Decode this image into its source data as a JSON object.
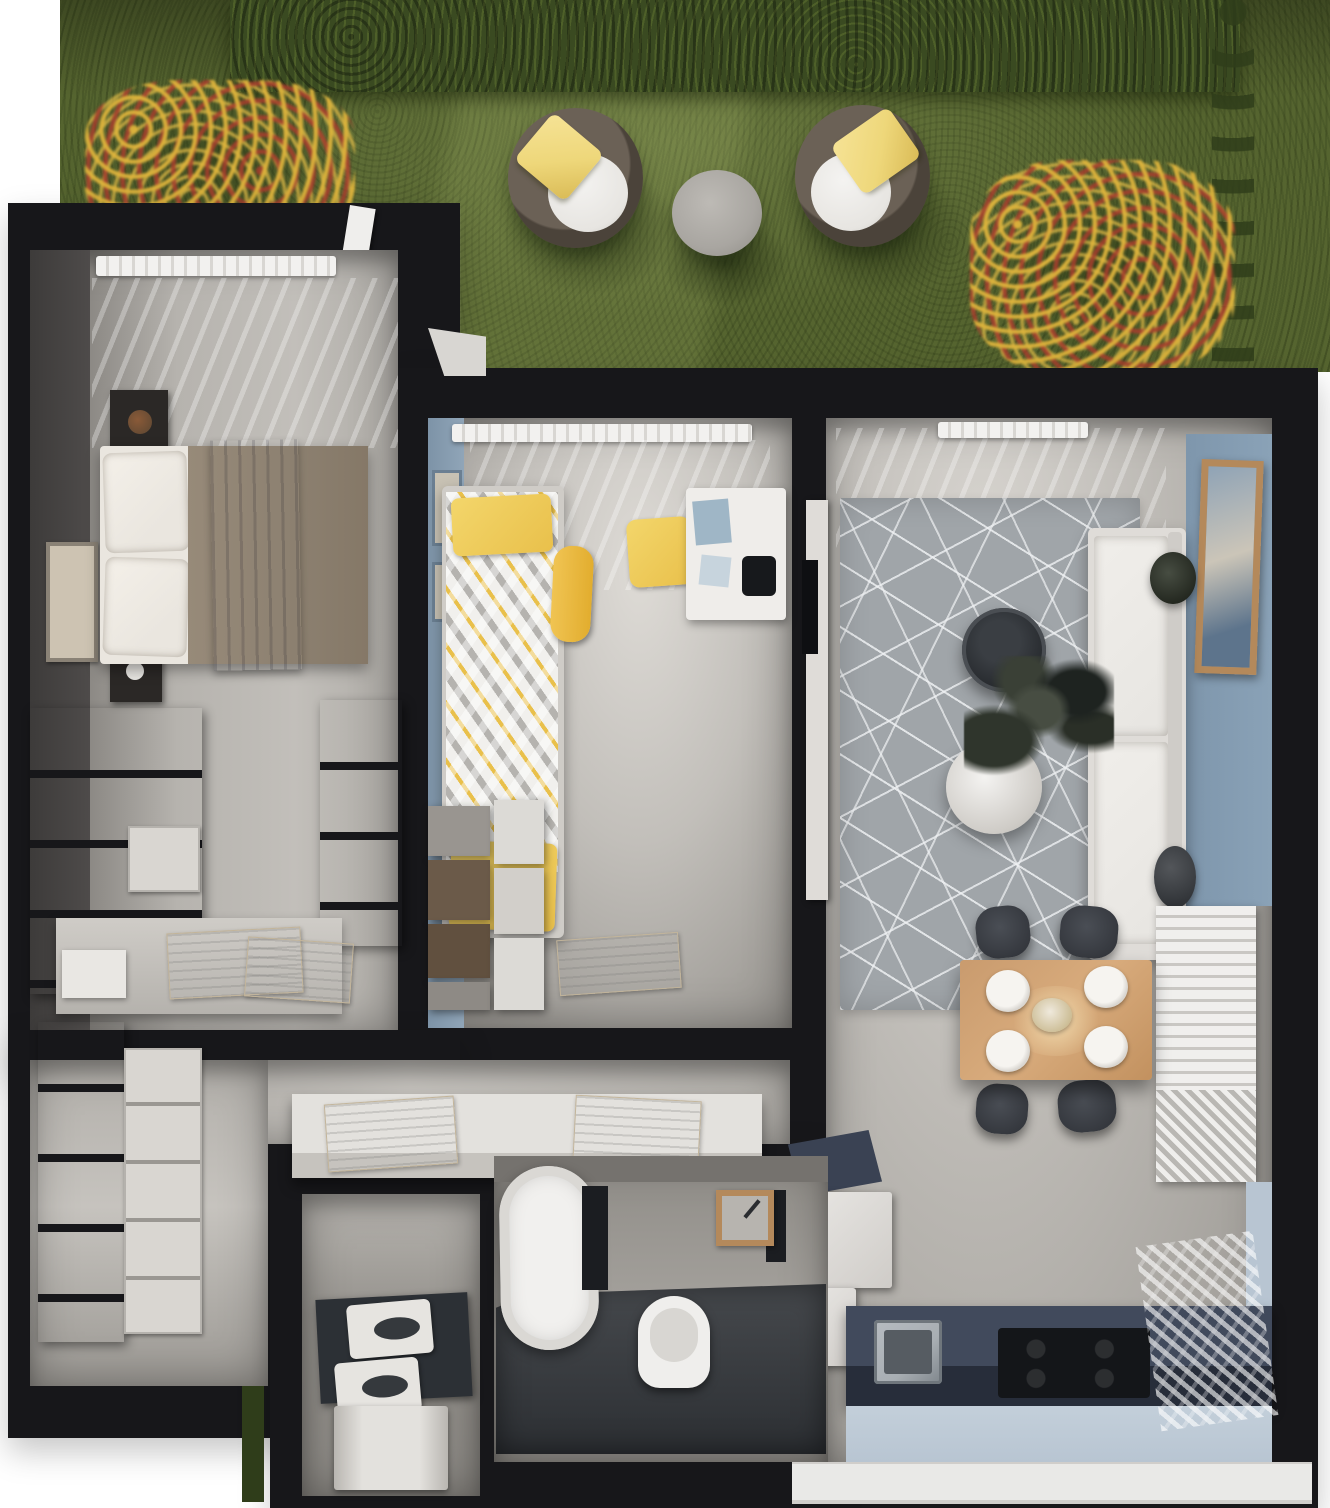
{
  "meta": {
    "title": "apartment-floor-plan-3d-render"
  },
  "palette": {
    "wall": "#17171a",
    "grass": "#55642f",
    "hedge": "#3a4a21",
    "hedgeD": "#2f3d1a",
    "chairFrame": "#4b433a",
    "cushion": "#e7e5e1",
    "pillow": "#eed77a",
    "gtable": "#a9a6a1",
    "bwall": "#4e4b4a",
    "nstand": "#2b2826",
    "linen": "#eae6df",
    "duvet": "#8d8171",
    "throw": "#5b7492",
    "wood": "#6c5947",
    "drawer": "#d9d6d1",
    "kblue": "#90a5b8",
    "kyellow": "#e9c04b",
    "rug": "#a0a5a9",
    "sofa": "#e7e5e1",
    "accent": "#8aa2b7",
    "frame": "#b4895b",
    "navy": "#3a4253",
    "navyD": "#272d3a",
    "cooktop": "#141619",
    "steel": "#a8aeb3",
    "kfloorL": "#b8c5d2",
    "windowB": "#e9e9e7",
    "tub": "#f1f0ee",
    "part": "#1b1d21",
    "ucounter": "#2c3035"
  },
  "scene": {
    "garden_terrace": [
      "hedge",
      "flower-bed",
      "flower-bed",
      "lounge-chair",
      "lounge-chair",
      "side-table"
    ],
    "bedroom": [
      "radiator",
      "nightstand",
      "nightstand",
      "double-bed",
      "wall-art",
      "dresser",
      "dresser",
      "desk",
      "magazines"
    ],
    "kids_room": [
      "radiator",
      "single-bed",
      "skateboard",
      "chair",
      "desk",
      "lamp",
      "dresser",
      "rug"
    ],
    "living_room": [
      "radiator",
      "area-rug",
      "coffee-table",
      "sofa",
      "plant",
      "accent-wall",
      "framed-art",
      "shelf",
      "planter",
      "tv"
    ],
    "dining_area": [
      "table",
      "chair",
      "chair",
      "chair",
      "chair",
      "plates",
      "centerpiece"
    ],
    "kitchen": [
      "fridge",
      "counter",
      "sink",
      "cooktop",
      "window-wall"
    ],
    "hallway": [
      "wardrobe",
      "console",
      "open-book",
      "open-book"
    ],
    "bathroom": [
      "bathtub",
      "toilet",
      "sink",
      "shower",
      "partition"
    ],
    "utility_room": [
      "washer",
      "dryer",
      "appliance",
      "counter"
    ]
  }
}
